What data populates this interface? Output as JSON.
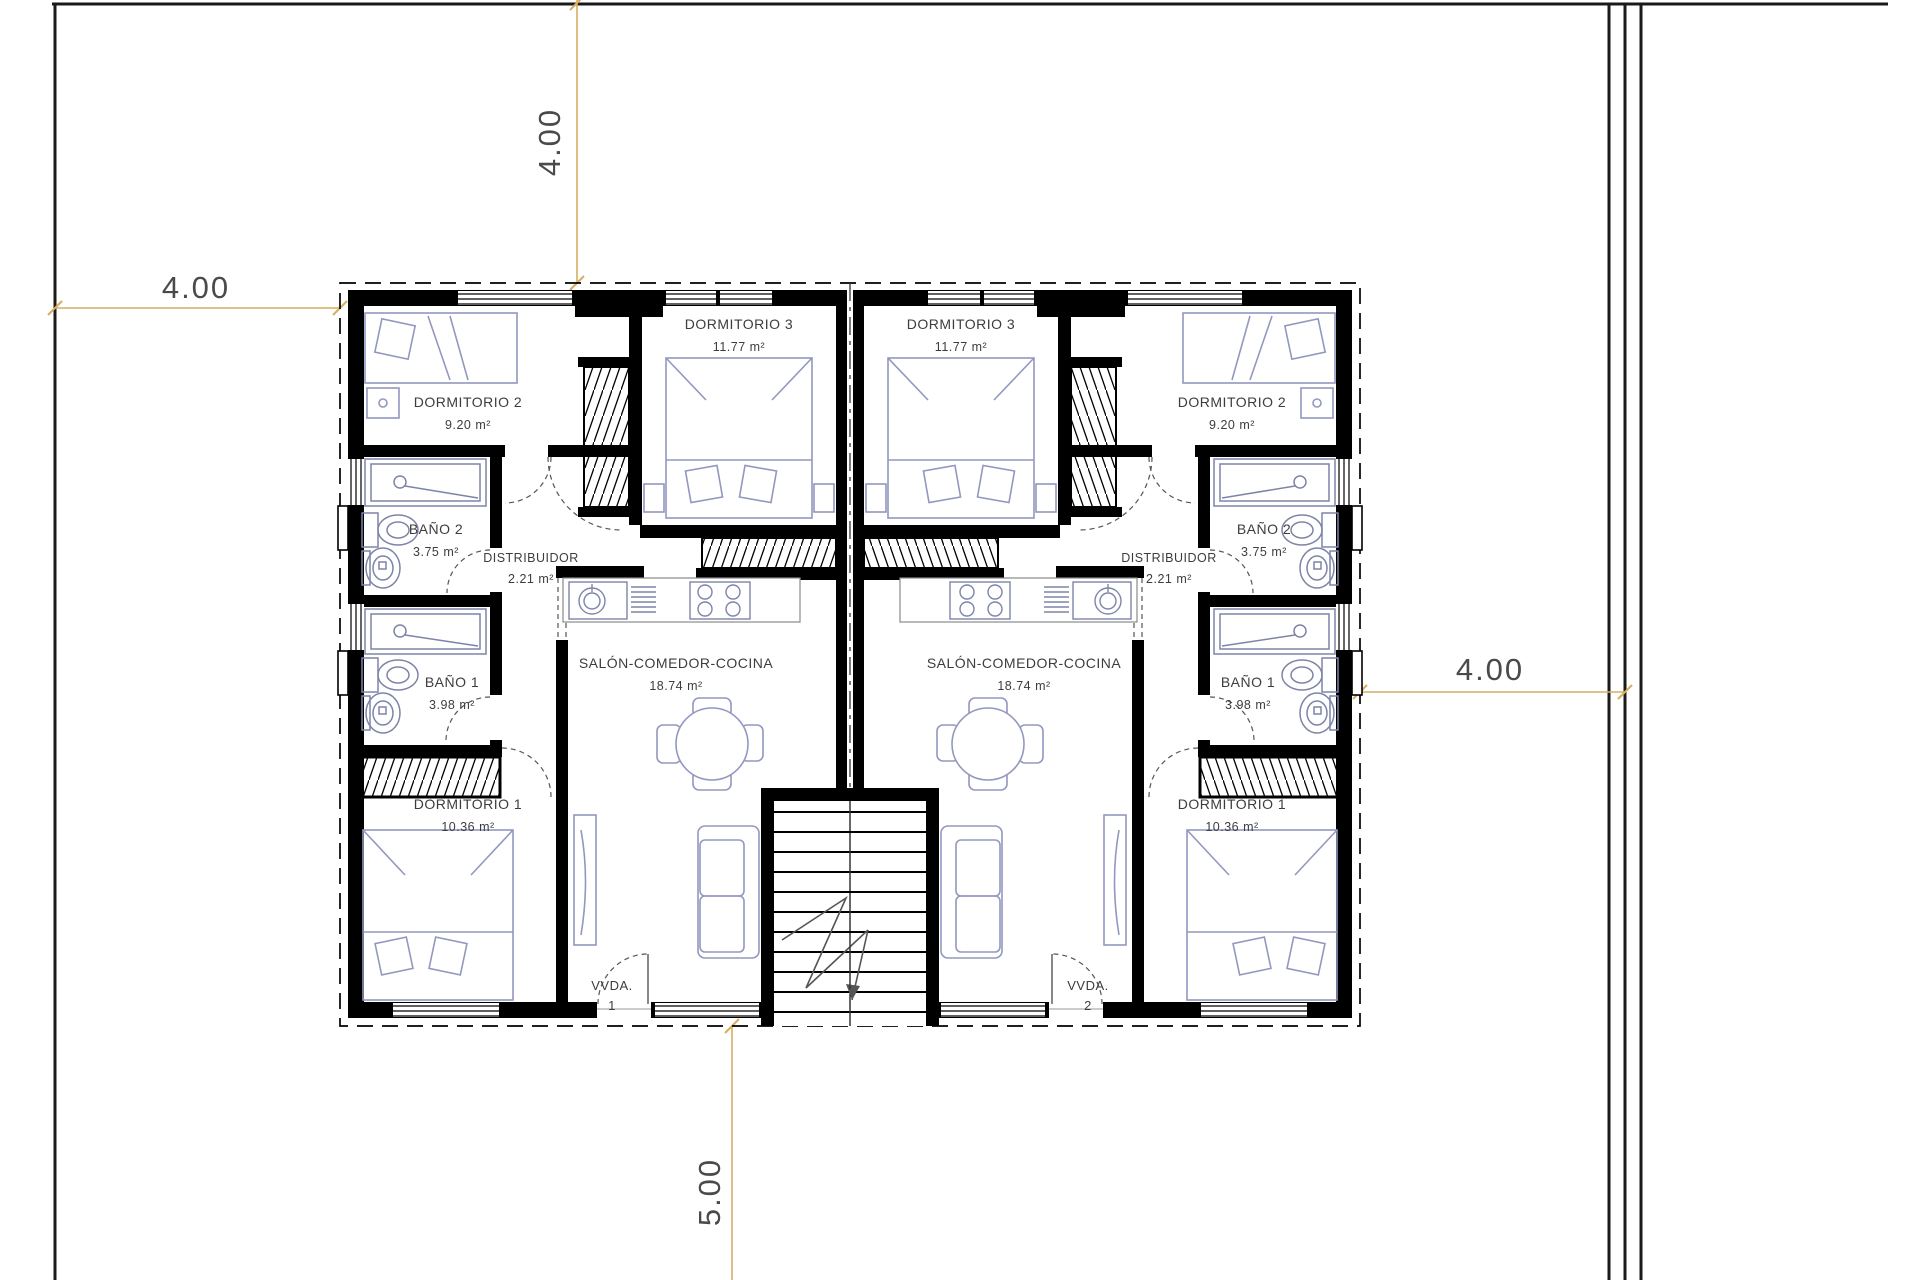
{
  "plan": {
    "dimensions": {
      "top": "4.00",
      "left": "4.00",
      "right": "4.00",
      "bottom": "5.00"
    },
    "rooms": {
      "dormitorio2": {
        "label": "DORMITORIO 2",
        "area": "9.20 m²"
      },
      "dormitorio3": {
        "label": "DORMITORIO 3",
        "area": "11.77 m²"
      },
      "bano2": {
        "label": "BAÑO 2",
        "area": "3.75 m²"
      },
      "distribuidor": {
        "label": "DISTRIBUIDOR",
        "area": "2.21 m²"
      },
      "bano1": {
        "label": "BAÑO 1",
        "area": "3.98 m²"
      },
      "dormitorio1": {
        "label": "DORMITORIO 1",
        "area": "10.36 m²"
      },
      "salon": {
        "label": "SALÓN-COMEDOR-COCINA",
        "area": "18.74 m²"
      }
    },
    "units": {
      "vvda1_line1": "VVDA.",
      "vvda1_line2": "1",
      "vvda2_line1": "VVDA.",
      "vvda2_line2": "2"
    },
    "colors": {
      "dimension_line": "#d6ad62",
      "wall": "#000000",
      "furniture": "#9298bf",
      "fixture": "#7d84a8"
    }
  }
}
